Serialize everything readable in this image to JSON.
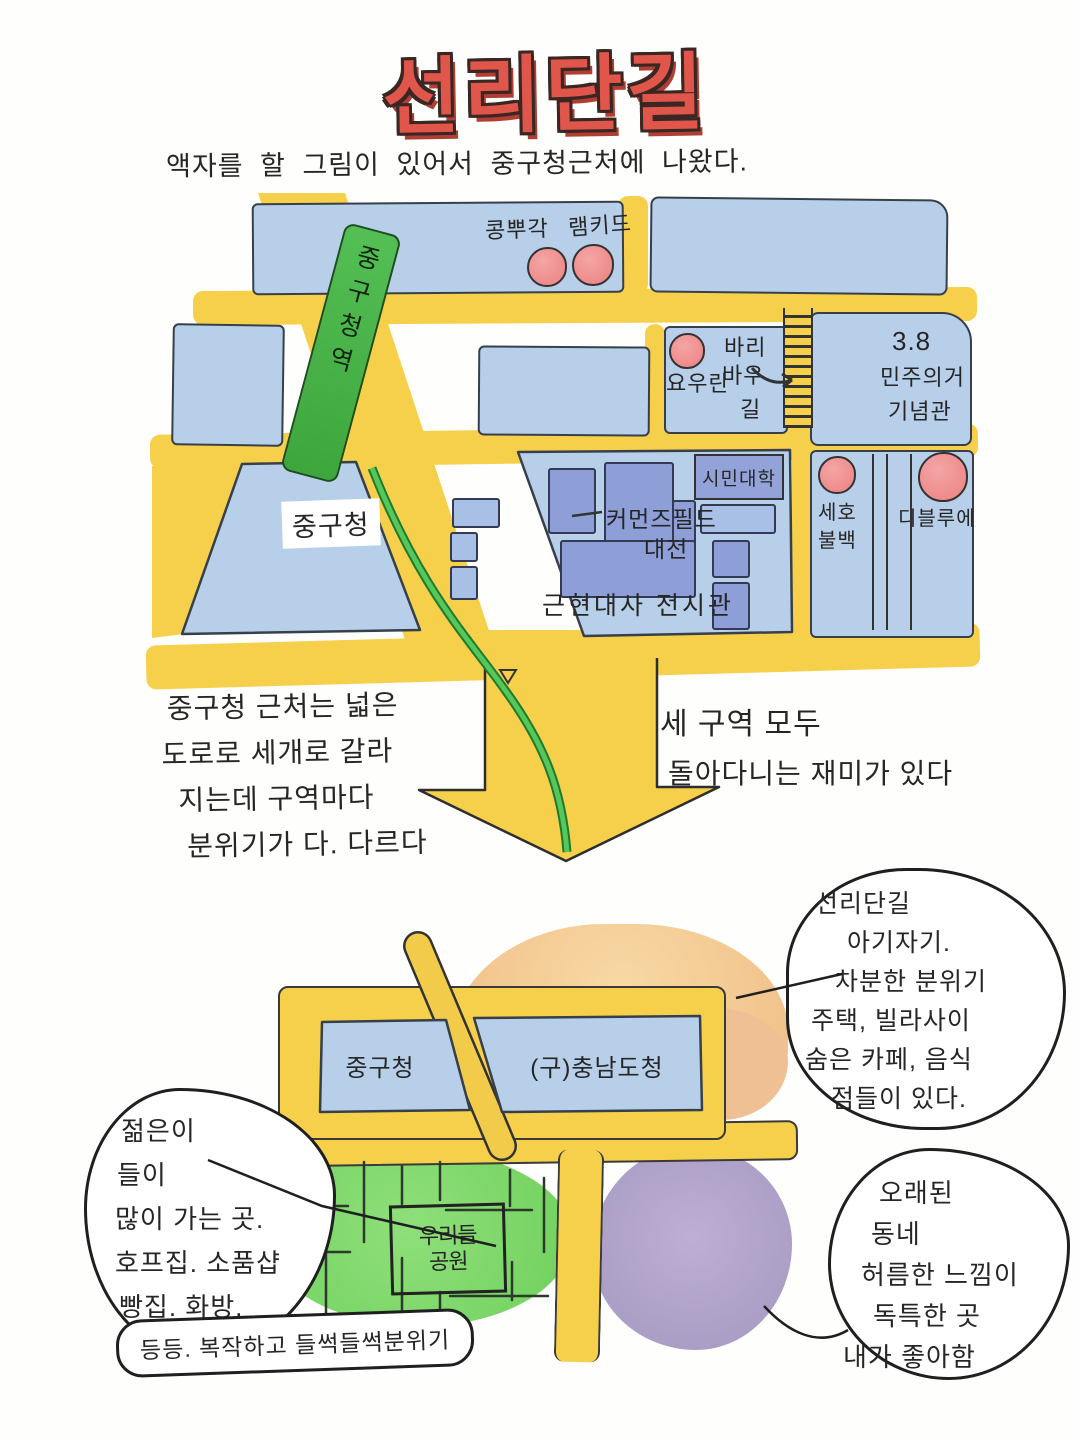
{
  "palette": {
    "title_red": "#e0564a",
    "road_yellow": "#f6d04b",
    "block_blue": "#b7cfe9",
    "building_purple": "#8e9ed6",
    "tram_green": "#4db84d",
    "shop_dot_red": "#ee8888",
    "memorial_peach": "#f3bd9b",
    "area_orange": "#f3c78f",
    "area_green": "#82d96d",
    "area_purple": "#b0a2c9",
    "ink": "#2b2b2b"
  },
  "header": {
    "title": "선리단길",
    "subtitle": "액자를 할 그림이 있어서 중구청근처에 나왔다."
  },
  "top_map": {
    "shops_top": {
      "shop1": "콩뿌각",
      "shop2": "램키드"
    },
    "youran_block": {
      "shop": "요우란",
      "street_line1": "바리",
      "street_line2": "바우",
      "street_line3": "길"
    },
    "memorial": {
      "line1": "3.8",
      "line2": "민주의거",
      "line3": "기념관"
    },
    "station": "중구청역",
    "gu_office": "중구청",
    "commons": {
      "line1": "커먼즈필드",
      "line2": "대전"
    },
    "museum": "근현대사 전시관",
    "citizen_college": "시민대학",
    "seho": {
      "line1": "세호",
      "line2": "불백"
    },
    "dbleue": "디블루에"
  },
  "notes": {
    "left": {
      "l1": "중구청 근처는 넓은",
      "l2": "도로로 세개로 갈라",
      "l3": "지는데 구역마다",
      "l4": "분위기가 다. 다르다"
    },
    "right": {
      "l1": "세 구역 모두",
      "l2": "돌아다니는 재미가 있다"
    }
  },
  "bottom_map": {
    "gu_office": "중구청",
    "old_provincial_office": "(구)충남도청",
    "park": {
      "line1": "우리들",
      "line2": "공원"
    }
  },
  "bubbles": {
    "seonridan": {
      "l1": "선리단길",
      "l2": "아기자기.",
      "l3": "차분한 분위기",
      "l4": "주택, 빌라사이",
      "l5": "숨은 카페, 음식",
      "l6": "점들이 있다."
    },
    "young": {
      "l1": "젊은이",
      "l2": "들이",
      "l3": "많이 가는 곳.",
      "l4": "호프집. 소품샵",
      "l5": "빵집. 화방.",
      "l6": "등등. 복작하고 들썩들썩분위기"
    },
    "old_town": {
      "l1": "오래된",
      "l2": "동네",
      "l3": "허름한 느낌이",
      "l4": "독특한 곳",
      "l5": "내가 좋아함"
    }
  }
}
